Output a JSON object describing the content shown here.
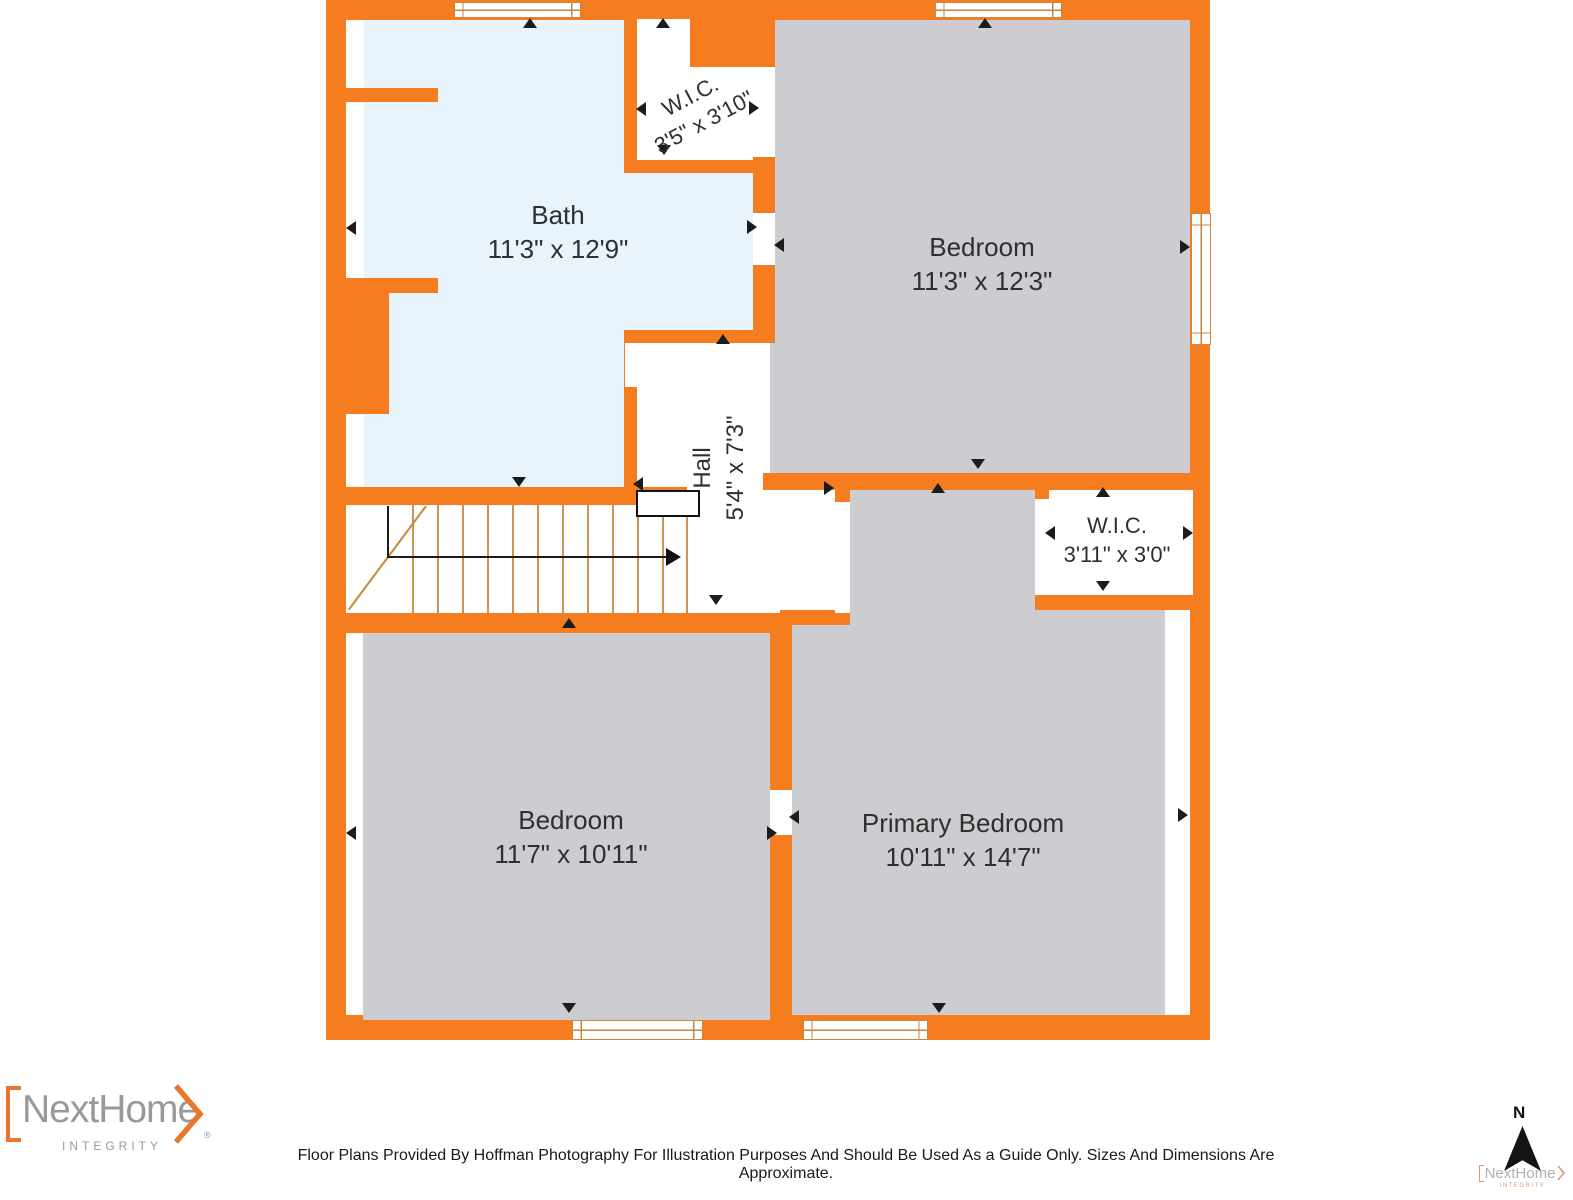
{
  "plan": {
    "rooms": [
      {
        "name": "Bath",
        "dims": "11'3\" x 12'9\""
      },
      {
        "name": "W.I.C.",
        "dims": "3'5\" x 3'10\""
      },
      {
        "name": "Bedroom",
        "dims": "11'3\" x 12'3\""
      },
      {
        "name": "Hall",
        "dims": "5'4\" x 7'3\""
      },
      {
        "name": "W.I.C.",
        "dims": "3'11\" x 3'0\""
      },
      {
        "name": "Bedroom",
        "dims": "11'7\" x 10'11\""
      },
      {
        "name": "Primary Bedroom",
        "dims": "10'11\" x 14'7\""
      }
    ],
    "colors": {
      "wall_orange": "#f57d20",
      "bath_blue": "#e9f3fb",
      "floor_gray": "#cdccd0",
      "stair_tread_tan": "#cf9353"
    }
  },
  "footer": {
    "logo": {
      "brand": "NextHome",
      "tagline": "INTEGRITY",
      "registered": "®"
    },
    "disclaimer": "Floor Plans Provided By Hoffman Photography For Illustration Purposes And Should Be Used As a Guide Only. Sizes And Dimensions Are Approximate.",
    "compass": {
      "label": "N"
    },
    "watermark": {
      "brand": "NextHome",
      "tagline": "INTEGRITY"
    }
  }
}
